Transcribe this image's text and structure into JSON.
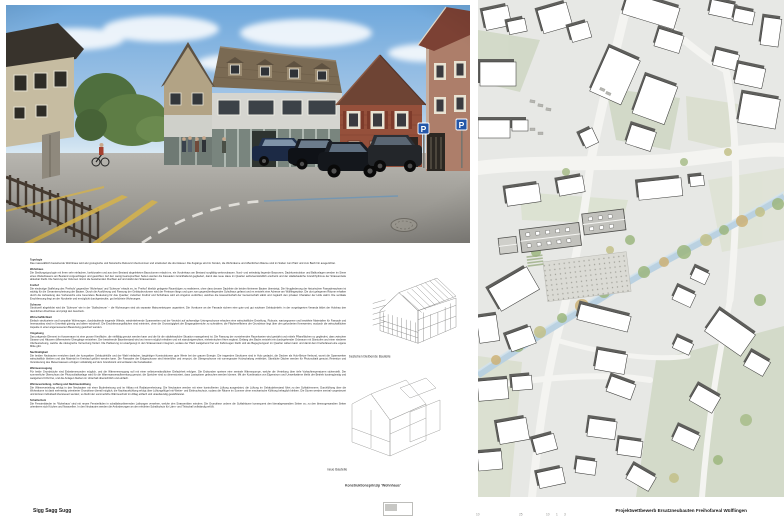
{
  "colors": {
    "sky_blue": "#6fa8dc",
    "roof_brown": "#7a6a53",
    "facade_red": "#95503b",
    "marking_yellow": "#d3b14e",
    "map_green": "#ccd5bf",
    "stream_blue": "#b7d0e0",
    "parking_sign_blue": "#2456a8"
  },
  "rendering": {
    "parking_sign_label": "P"
  },
  "text_columns": {
    "sections": [
      {
        "heading": "Typologie",
        "body": "Das massstäblich bestehende Wohnhaus wird als typologische und historische Referenz übernommen und strukturiert die drei Häuser. Die Zugänge sind im Norden, die Wohnräume und öffentlichen Räume sind im Süden zum Platz und zum Bach hin ausgerichtet."
      },
      {
        "heading": "Wohnhaus",
        "body": "Die Siedlungstypologie mit ihren sehr einfachen, funktionalen und aus dem Bestand abgeleiteten Bauvolumen erlaubt es, ein Vorderhaus am Bestand sorgfältig weiterzubauen. Nord- und seitwärtig liegende Bauzonen, Dachkonstruktion und Balkonlagen werden im Sinne eines Weiterbauens am Bestand vorgeschlagen und gewichtet. Auf den wenig beanspruchten Seiten werden die Fassaden zurückhaltend gegliedert, damit das neue Haus im Quartier selbstverständlich erscheint und der städtebauliche Grundrhythmus der Strassenzeile ablesbar bleibt. Die Setzung der Volumen nimmt die bestehenden Fluchten auf und stärkt den Strassenraum."
      },
      {
        "heading": "Freihof",
        "body": "Die eindeutige Staffelung des 'Freihofs' gegenüber 'Wohnhaus' und 'Scheune' erlaubt es, im 'Freihof' ähnlich gelagerte Raumfolgen zu realisieren, ohne dass dessen Dachlinie die beiden kleineren Bauten übersteigt. Die Neugliederung der historischen Fassadenachsen ist wichtig für die Gesamterscheinung der Bauten. Durch die Ausführung und Fassung der Gebäudevolumen wird der Freiraum längs und quer zum gegenüberliegenden Schulhaus gefasst und es entsteht eine Adresse am Wülflingerplatz. Die dort gelegenen Räume erhalten durch die Aufweitung des Vorbereichs eine besondere Bedeutung für das Quartier; zwischen Freihof und Schulhaus wird ein Angebot verdichtet, welches die Hauswirtschaft der Gemeinschaft stärkt und zugleich den privaten Charakter der Höfe wahrt. Die vertikale Erschliessung liegt an der Nordseite und ermöglicht durchgesteckte, gut belichtete Wohnungen."
      },
      {
        "heading": "Scheune",
        "body": "Strukturell abgebildet wird die 'Scheune' wie in der 'Stallscheune' – die Wohnungen sind als separate Maisonettetypen organisiert. Die Vorräume an der Fassade sichern eine gute und gut nutzbare Gebäudetiefe; in der vorgelagerten Veranda bildet der Holzbau den räumlichen Abschluss und prägt den Ausdruck."
      },
      {
        "heading": "Wirtschaftlichkeit",
        "body": "Einfach strukturierte und kompakte Wohnungen, durchlaufende tragende Wände, wiederkehrende Spannweiten und der Verzicht auf aufwendige Untergeschosse erlauben eine wirtschaftliche Erstellung. Robuste, wartungsarme und bewährte Materialien für Fassade und Innenausbau sind im Unterhalt günstig und altern würdevoll. Die Erschliessungsflächen sind minimiert, ohne die Grosszügigkeit der Eingangsbereiche zu schmälern; die Flächeneffizienz der Grundrisse liegt über den geforderten Kennwerten, wodurch die wirtschaftlichen Aspekte in einer angemessenen Bewertung gesichert werden."
      },
      {
        "heading": "Umgebung",
        "body": "Das prägende Element im Aussenraum ist eine grosse Kiesfläche, die vielfältig genutzt werden kann und die für die städtebauliche Situation massgebend ist. Die Fassung der vorstehenden Raumkanten wird gestärkt und mittels Pflanzflächen so gegliedert, dass zwischen Strasse und Häusern differenzierte Übergänge entstehen. Der bestehende Baumbestand wird wo immer möglich erhalten und mit standortgerechten, einheimischen Arten ergänzt. Entlang des Bachs entsteht ein durchgehender Grünraum mit Sitzstufen und einer niederen Uferbestockung, welche die ökologische Vernetzung fördert. Die Parkierung ist unaufgeregt in den Strassenraum integriert, sodass der Platz weitgehend frei von Fahrzeugen bleibt und als Begegnungsort im Quartier wirken kann und damit dem Freihofareal eine eigene Mitte gibt."
      },
      {
        "heading": "Nachhaltigkeit",
        "body": "Die beiden Neubauten erreichen dank der kompakten Gebäudehülle und der Wahl einfacher, langlebiger Konstruktionen gute Werte bei der grauen Energie. Die tragenden Strukturen sind in Holz gedacht, die Decken als Holz-Beton-Verbund, womit die Spannweiten wirtschaftlich bleiben und das Material im Kreislauf geführt werden kann. Die Fassaden der Erdgeschosse sind hinterlüftet und verputzt, die Obergeschosse mit vorvergrauter Holzschalung verkleidet. Sämtliche Dächer werden für Photovoltaik genutzt; Retention und Versickerung des Meteorwassers erfolgen vollständig auf dem Grundstück und entlasten die Kanalisation."
      },
      {
        "heading": "Wärmeerzeugung",
        "body": "Für beide Grundstücke sind Erdwärmesonden möglich, und die Wärmeerzeugung soll mit einer selbstverständlichen Einfachheit erfolgen. Die Erdsonden speisen eine zentrale Wärmepumpe, welche die Verteilung über tiefe Vorlauftemperaturen sicherstellt. Der sommerliche Überschuss der Photovoltaikanlage wird für die Warmwasseraufbereitung genutzt; die Speicher sind so dimensioniert, dass Lastspitzen gebrochen werden können. Mit der Kombination von Eigenstrom und Umweltwärme bleibt der Betrieb kostengünstig und weitgehend CO2-frei, und die Anlagen bleiben im Unterhalt übersichtlich und einfach."
      },
      {
        "heading": "Wärmeverteilung, Lüftung und Nachtauskühlung",
        "body": "Die Wärmeverteilung erfolgt in den Neubauten mit einer Bodenheizung und im Altbau mit Radiatorenheizung. Die Neubauten werden mit einer kontrollierten Lüftung ausgerüstet; die Lüftung im Gebäudebestand führt zu den Schlafzimmern. Durchlüftung über die Wohnräume ist dank mehrseitig orientierter Grundrisse überall möglich, die Nachtauskühlung erfolgt über Lüftungsflügel mit Wetter- und Einbruchschutz, sodass die Räume im Sommer ohne mechanische Kühlung behaglich bleiben. Die Storen werden zentral vorgesteuert und können individuell übersteuert werden; so bleibt der sommerliche Wärmeschutz im Alltag einfach und unaufwendig gewährleistet."
      },
      {
        "heading": "Schallschutz",
        "body": "Die Fensterbänder im 'Wohnhaus' sind mit neuen Fensterläden in schallabsorbierenden Laibungen versehen, welche den Strassenlärm mindern. Die Grundrisse ordnen die Schlafräume konsequent den lärmabgewandten Seiten zu; zu den lärmzugewandten Seiten orientieren sich Küchen und Nasszellen. In den Neubauten werden die Anforderungen an den erhöhten Schallschutz für Lärm- und Trittschall vollständig erfüllt."
      }
    ]
  },
  "figures": {
    "existing_caption": "bestehen bleibende Bauteile",
    "new_caption": "neue Bauteile",
    "principle_caption": "Konstruktionsprinzip 'Wohnhaus'"
  },
  "footer": {
    "motto": "Sigg Sagg Sugg",
    "title": "Projektwettbewerb Ersatzneubauten Freihofareal Wülflingen",
    "scale_marks": [
      "10",
      "25",
      "10",
      "1",
      "3"
    ]
  }
}
